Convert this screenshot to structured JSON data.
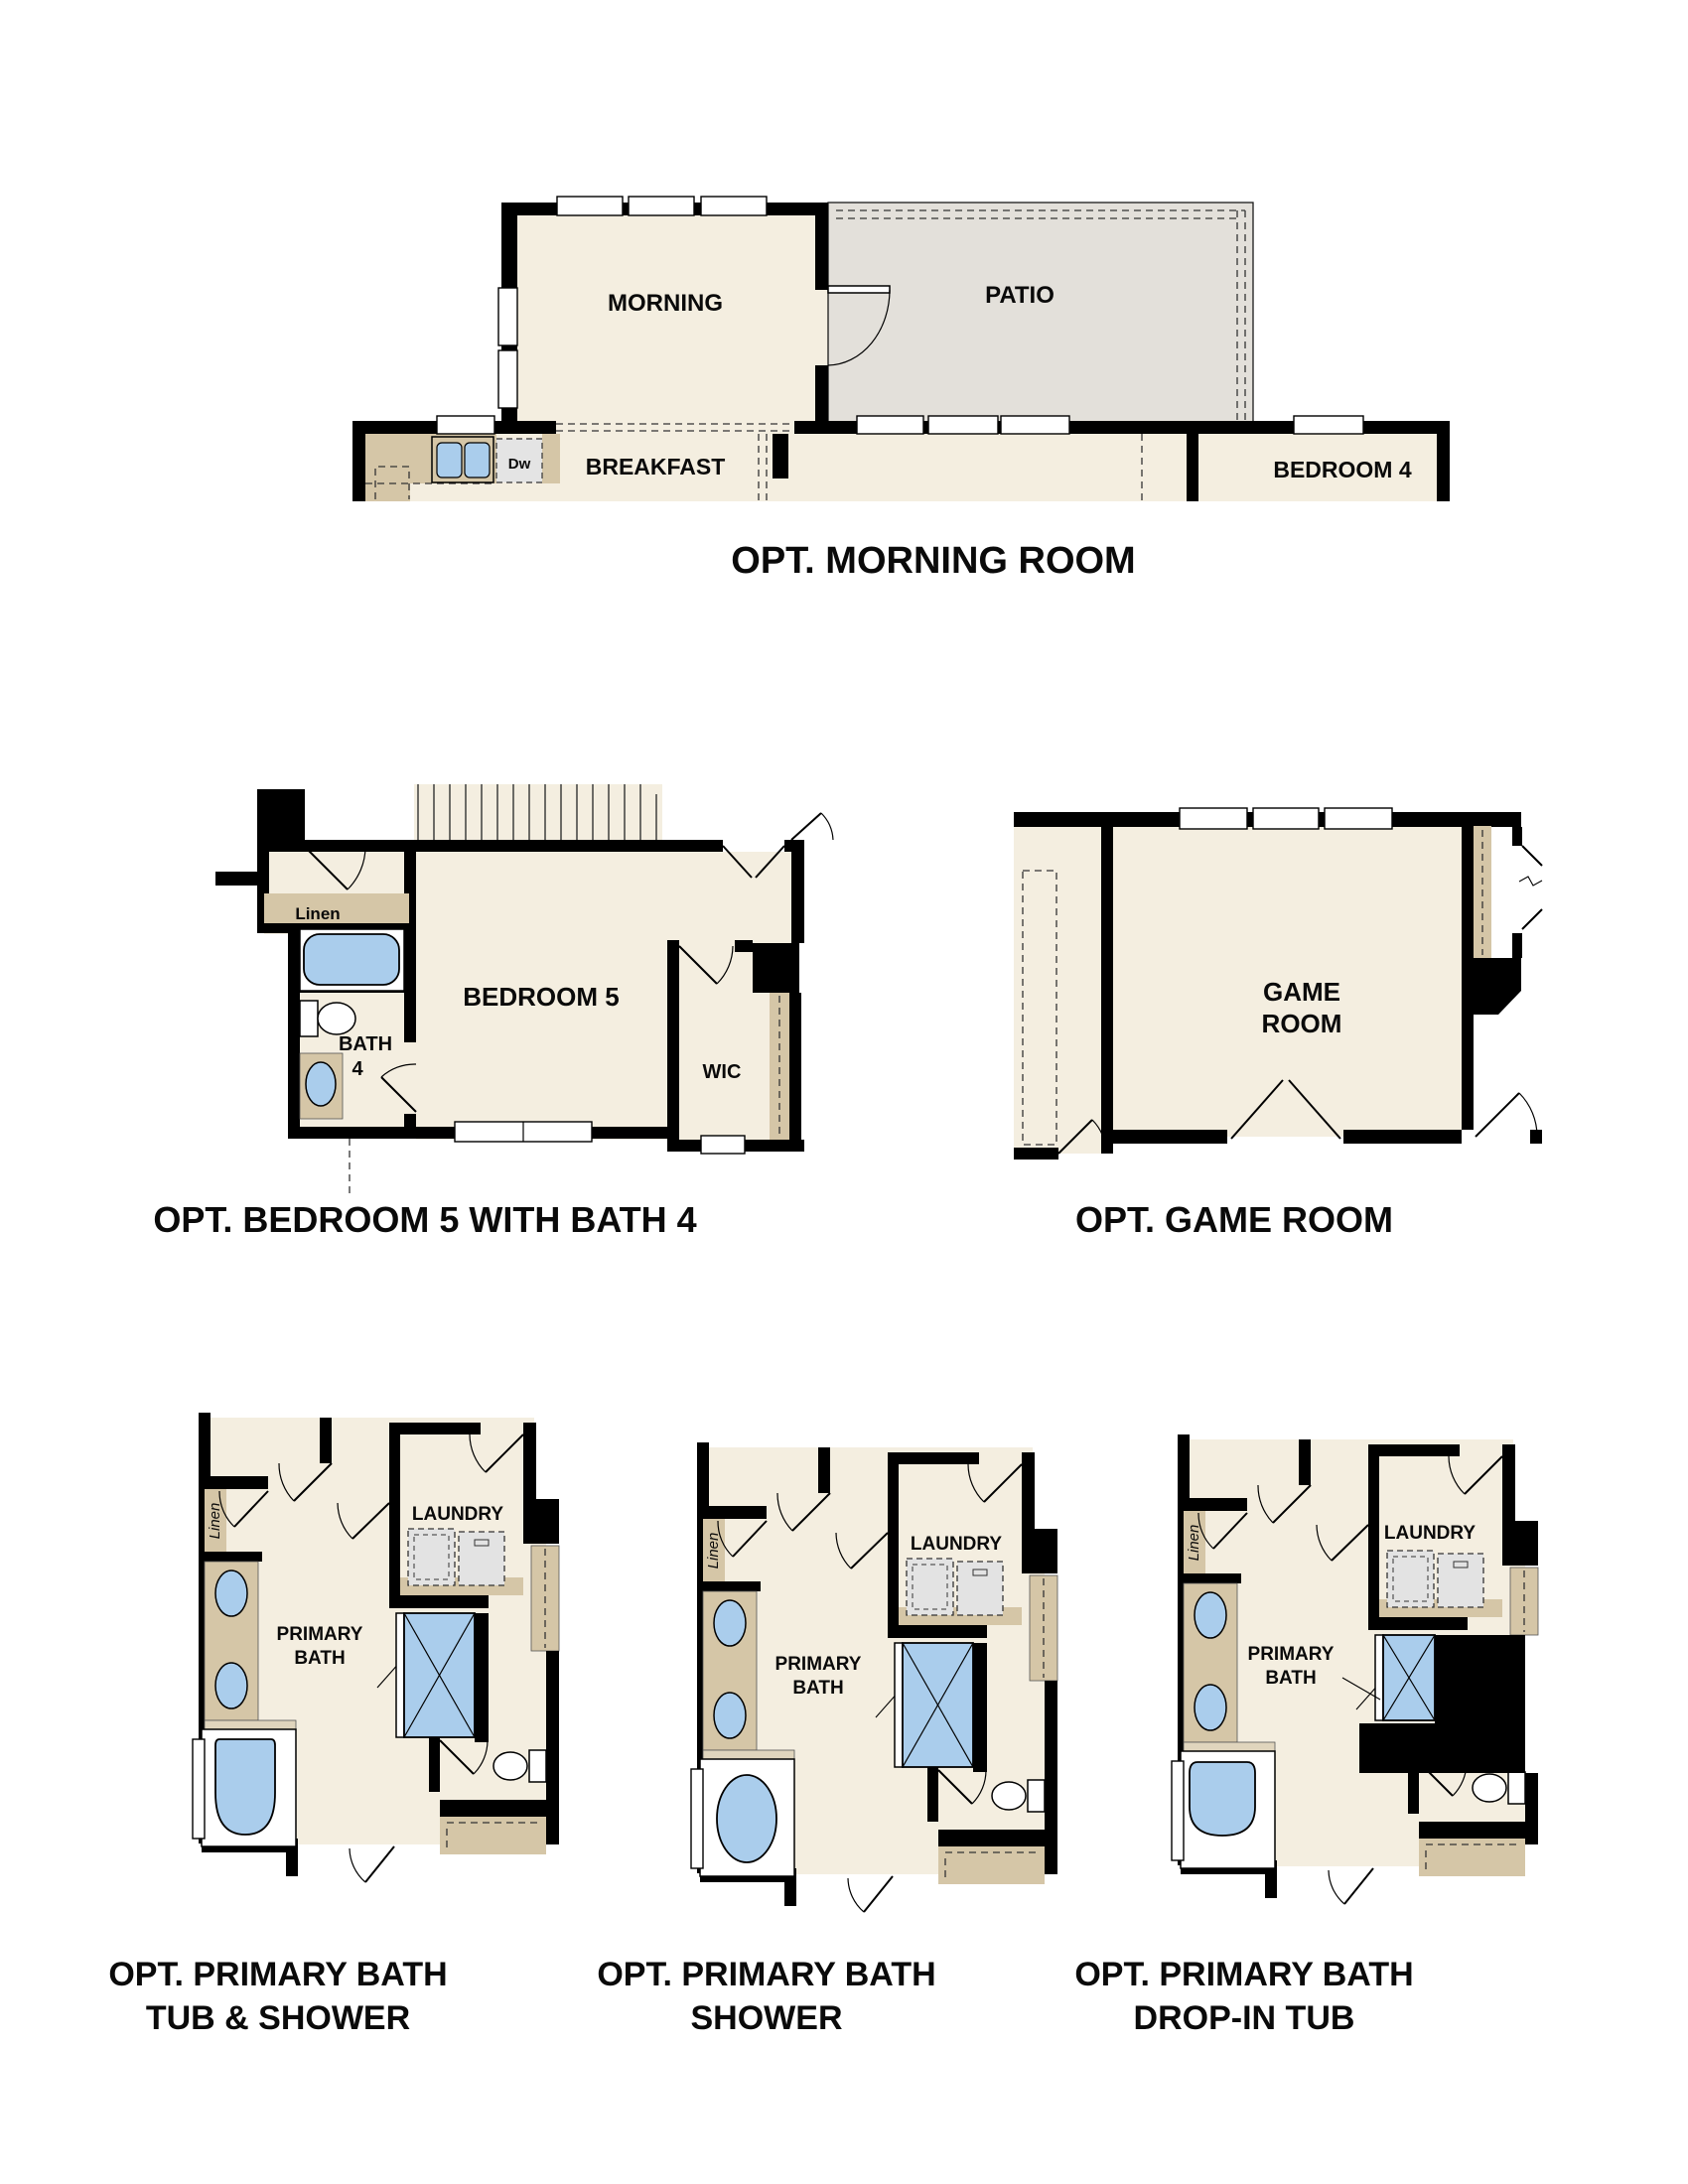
{
  "colors": {
    "floor_cream": "#f4eee0",
    "patio_gray": "#e3e0da",
    "counter_tan": "#d5c6a7",
    "counter_edge_tan": "#e0d5bd",
    "fixture_blue": "#aacdec",
    "appliance_gray": "#e3e3e3",
    "wall_black": "#000000"
  },
  "plans": {
    "morning": {
      "title": "OPT. MORNING ROOM",
      "rooms": {
        "morning": "MORNING",
        "patio": "PATIO",
        "breakfast": "BREAKFAST",
        "dishwasher": "Dw",
        "bedroom4": "BEDROOM 4"
      }
    },
    "bedroom5": {
      "title": "OPT. BEDROOM 5 WITH BATH 4",
      "rooms": {
        "bedroom5": "BEDROOM 5",
        "linen": "Linen",
        "bath": "BATH",
        "bath_num": "4",
        "wic": "WIC"
      }
    },
    "game": {
      "title": "OPT. GAME ROOM",
      "rooms": {
        "game1": "GAME",
        "game2": "ROOM"
      }
    },
    "bath_tub_shower": {
      "title1": "OPT. PRIMARY BATH",
      "title2": "TUB & SHOWER",
      "rooms": {
        "linen": "Linen",
        "laundry": "LAUNDRY",
        "primary1": "PRIMARY",
        "primary2": "BATH"
      }
    },
    "bath_shower": {
      "title1": "OPT. PRIMARY BATH",
      "title2": "SHOWER",
      "rooms": {
        "linen": "Linen",
        "laundry": "LAUNDRY",
        "primary1": "PRIMARY",
        "primary2": "BATH"
      }
    },
    "bath_dropin": {
      "title1": "OPT. PRIMARY BATH",
      "title2": "DROP-IN TUB",
      "rooms": {
        "linen": "Linen",
        "laundry": "LAUNDRY",
        "primary1": "PRIMARY",
        "primary2": "BATH"
      }
    }
  }
}
